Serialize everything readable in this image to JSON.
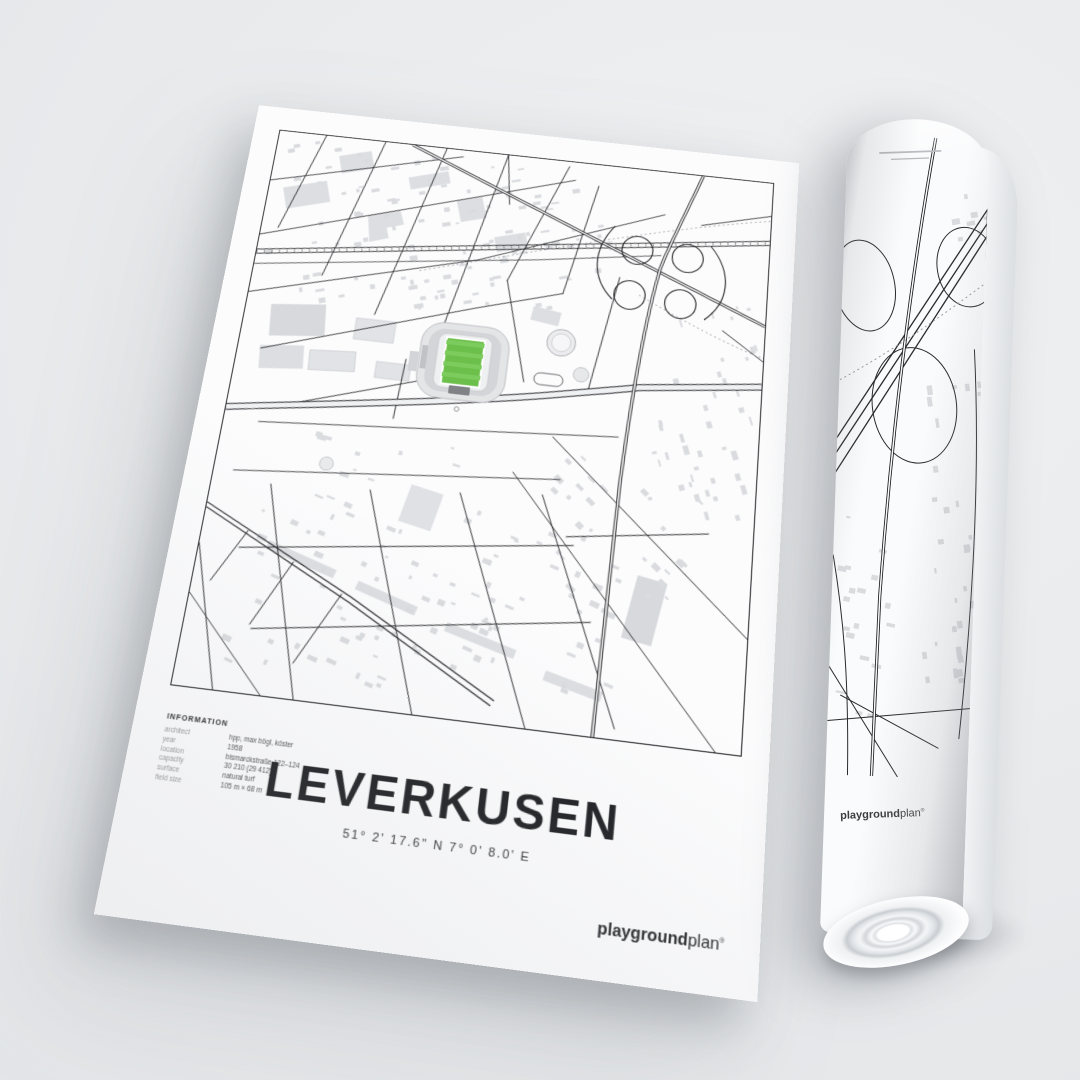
{
  "poster": {
    "title": "LEVERKUSEN",
    "coordinates": "51° 2' 17.6\" N  7° 0' 8.0' E",
    "info": {
      "heading": "INFORMATION",
      "rows": [
        {
          "label": "architect",
          "value": "hpp, max bögl, köster"
        },
        {
          "label": "year",
          "value": "1958"
        },
        {
          "label": "location",
          "value": "bismarckstraße 122–124"
        },
        {
          "label": "capacity",
          "value": "30 210 (29 412)"
        },
        {
          "label": "surface",
          "value": "natural turf"
        },
        {
          "label": "field size",
          "value": "105 m × 68 m"
        }
      ]
    },
    "map": {
      "pitch_color": "#6cbf4a",
      "pitch_stripe_color": "#7ccb5d",
      "building_color": "#d9dbde",
      "road_color": "#1d1d1f"
    }
  },
  "brand": {
    "bold": "playground",
    "light": "plan",
    "mark": "®"
  }
}
